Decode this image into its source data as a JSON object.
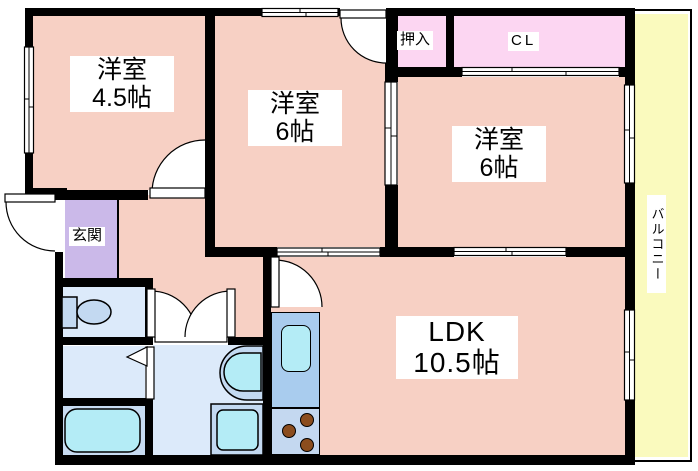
{
  "floorplan": {
    "rooms": {
      "bedroom1": {
        "type": "洋室",
        "size": "4.5帖"
      },
      "bedroom2": {
        "type": "洋室",
        "size": "6帖"
      },
      "bedroom3": {
        "type": "洋室",
        "size": "6帖"
      },
      "ldk": {
        "type": "LDK",
        "size": "10.5帖"
      },
      "oshiire": {
        "label": "押入"
      },
      "closet": {
        "label": "CL"
      },
      "entrance": {
        "label": "玄関"
      },
      "balcony": {
        "label": "バルコニー"
      }
    },
    "colors": {
      "wall": "#000000",
      "room": "#f7d0c4",
      "closet": "#fcd6f2",
      "entrance": "#cbb9e9",
      "balcony": "#fafabe",
      "wet_area": "#dceafa",
      "bath": "#c8dcf2",
      "fixture": "#c3d9f1",
      "water": "#b4ecf6",
      "kitchen_counter": "#a9ccee",
      "stove": "#c4d8f0",
      "burner": "#8b4d1e"
    }
  }
}
